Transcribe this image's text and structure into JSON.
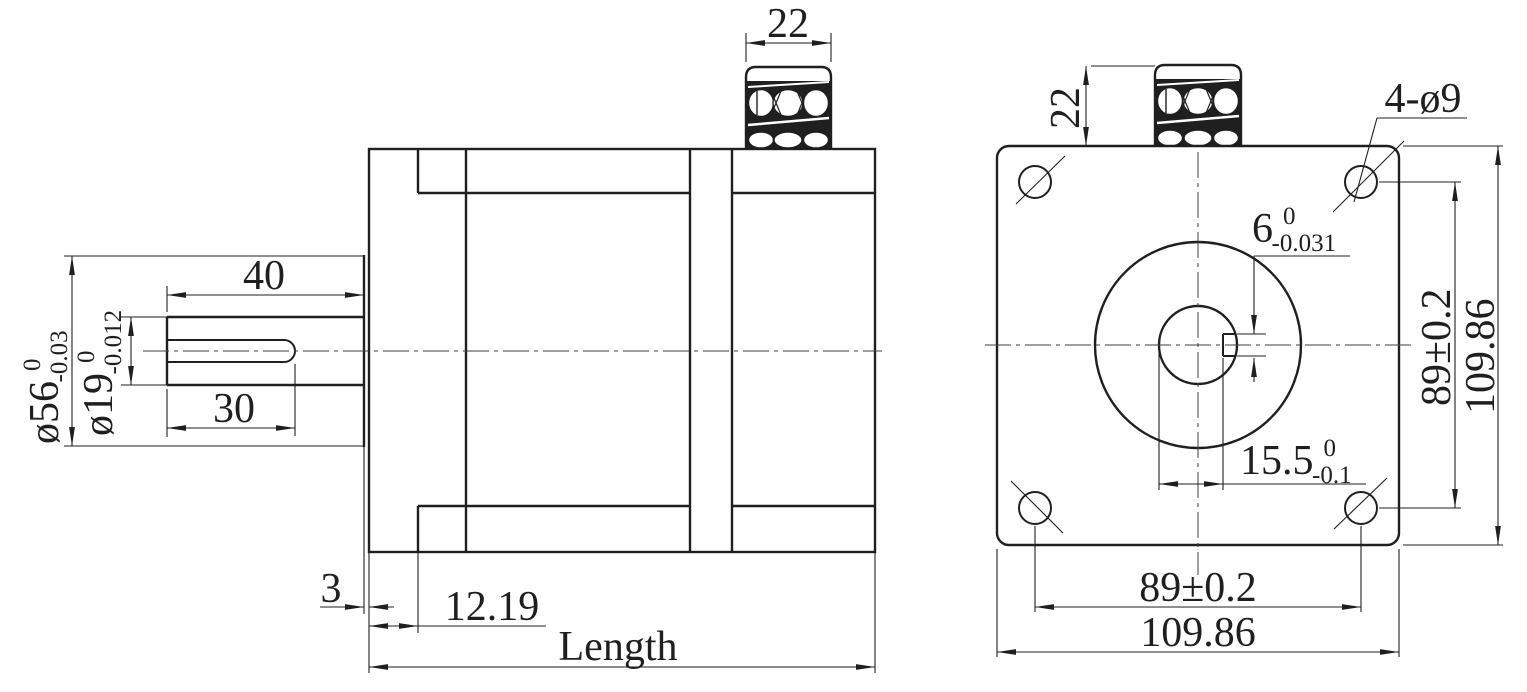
{
  "drawing_type": "stepper-motor-dimension-drawing",
  "line_color": "#1f1f1f",
  "side_view": {
    "connector_width": "22",
    "shaft_length": "40",
    "keyway_length": "30",
    "pilot_diameter": {
      "value": "ø56",
      "sup": "0",
      "sub": "-0.03"
    },
    "shaft_diameter": {
      "value": "ø19",
      "sup": "0",
      "sub": "-0.012"
    },
    "pilot_height": "3",
    "front_flange_depth": "12.19",
    "overall_length": "Length"
  },
  "front_view": {
    "connector_height": "22",
    "mounting_holes": "4-ø9",
    "keyway_width": {
      "value": "6",
      "sup": "0",
      "sub": "-0.031"
    },
    "keyway_depth": {
      "value": "15.5",
      "sup": "0",
      "sub": "-0.1"
    },
    "hole_spacing_vertical": "89±0.2",
    "frame_height": "109.86",
    "hole_spacing_horizontal": "89±0.2",
    "frame_width": "109.86"
  }
}
